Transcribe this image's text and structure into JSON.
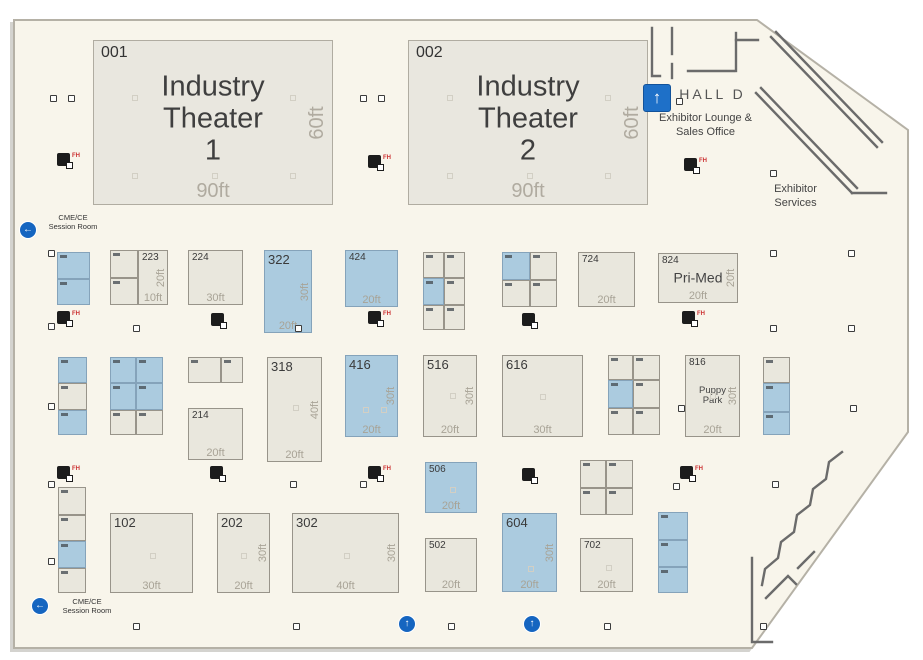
{
  "map": {
    "hall_label": "HALL D",
    "exhibitor_lounge": "Exhibitor Lounge &\nSales Office",
    "exhibitor_services": "Exhibitor\nServices",
    "session_room_top": "CME/CE\nSession Room",
    "session_room_bottom": "CME/CE\nSession Room",
    "colors": {
      "floor": "#f8f5eb",
      "booth_standard": "#e9e7dd",
      "booth_highlight": "#abcbdf",
      "arrow_blue": "#1565c0",
      "fire_label_red": "#cc3333",
      "dimension_gray": "#a8a396"
    }
  },
  "theaters": [
    {
      "booth": "001",
      "name": "Industry\nTheater\n1",
      "width_label": "90ft",
      "depth_label": "60ft"
    },
    {
      "booth": "002",
      "name": "Industry\nTheater\n2",
      "width_label": "90ft",
      "depth_label": "60ft"
    }
  ],
  "booths": [
    {
      "x": 57,
      "y": 252,
      "w": 33,
      "h": 27,
      "c": "b",
      "cell": true
    },
    {
      "x": 57,
      "y": 279,
      "w": 33,
      "h": 26,
      "c": "b",
      "cell": true
    },
    {
      "x": 110,
      "y": 250,
      "w": 28,
      "h": 28,
      "c": "s",
      "cell": true
    },
    {
      "x": 110,
      "y": 278,
      "w": 28,
      "h": 27,
      "c": "s",
      "cell": true
    },
    {
      "x": 138,
      "y": 250,
      "w": 30,
      "h": 55,
      "c": "s",
      "label": "223",
      "hd": "20ft",
      "wd": "10ft"
    },
    {
      "x": 188,
      "y": 250,
      "w": 55,
      "h": 55,
      "c": "s",
      "label": "224",
      "wd": "30ft"
    },
    {
      "x": 264,
      "y": 250,
      "w": 48,
      "h": 83,
      "c": "b",
      "label": "322",
      "lg": true,
      "hd": "30ft",
      "wd": "20ft"
    },
    {
      "x": 345,
      "y": 250,
      "w": 53,
      "h": 57,
      "c": "b",
      "label": "424",
      "wd": "20ft"
    },
    {
      "x": 423,
      "y": 252,
      "w": 21,
      "h": 26,
      "c": "s",
      "cell": true
    },
    {
      "x": 444,
      "y": 252,
      "w": 21,
      "h": 26,
      "c": "s",
      "cell": true
    },
    {
      "x": 423,
      "y": 278,
      "w": 21,
      "h": 27,
      "c": "b",
      "cell": true
    },
    {
      "x": 444,
      "y": 278,
      "w": 21,
      "h": 27,
      "c": "s",
      "cell": true
    },
    {
      "x": 423,
      "y": 305,
      "w": 21,
      "h": 25,
      "c": "s",
      "cell": true
    },
    {
      "x": 444,
      "y": 305,
      "w": 21,
      "h": 25,
      "c": "s",
      "cell": true
    },
    {
      "x": 502,
      "y": 252,
      "w": 28,
      "h": 28,
      "c": "b",
      "cell": true
    },
    {
      "x": 530,
      "y": 252,
      "w": 27,
      "h": 28,
      "c": "s",
      "cell": true
    },
    {
      "x": 502,
      "y": 280,
      "w": 28,
      "h": 27,
      "c": "s",
      "cell": true
    },
    {
      "x": 530,
      "y": 280,
      "w": 27,
      "h": 27,
      "c": "s",
      "cell": true
    },
    {
      "x": 578,
      "y": 252,
      "w": 57,
      "h": 55,
      "c": "s",
      "label": "724",
      "wd": "20ft"
    },
    {
      "x": 658,
      "y": 253,
      "w": 80,
      "h": 50,
      "c": "s",
      "label": "824",
      "name": "Pri-Med",
      "hd": "20ft",
      "wd": "20ft"
    },
    {
      "x": 58,
      "y": 357,
      "w": 29,
      "h": 26,
      "c": "b",
      "cell": true
    },
    {
      "x": 58,
      "y": 383,
      "w": 29,
      "h": 27,
      "c": "s",
      "cell": true
    },
    {
      "x": 58,
      "y": 410,
      "w": 29,
      "h": 25,
      "c": "b",
      "cell": true
    },
    {
      "x": 110,
      "y": 357,
      "w": 26,
      "h": 26,
      "c": "b",
      "cell": true
    },
    {
      "x": 136,
      "y": 357,
      "w": 27,
      "h": 26,
      "c": "b",
      "cell": true
    },
    {
      "x": 110,
      "y": 383,
      "w": 26,
      "h": 27,
      "c": "b",
      "cell": true
    },
    {
      "x": 136,
      "y": 383,
      "w": 27,
      "h": 27,
      "c": "b",
      "cell": true
    },
    {
      "x": 110,
      "y": 410,
      "w": 26,
      "h": 25,
      "c": "s",
      "cell": true
    },
    {
      "x": 136,
      "y": 410,
      "w": 27,
      "h": 25,
      "c": "s",
      "cell": true
    },
    {
      "x": 188,
      "y": 357,
      "w": 33,
      "h": 26,
      "c": "s",
      "cell": true
    },
    {
      "x": 221,
      "y": 357,
      "w": 22,
      "h": 26,
      "c": "s",
      "cell": true
    },
    {
      "x": 188,
      "y": 408,
      "w": 55,
      "h": 52,
      "c": "s",
      "label": "214",
      "wd": "20ft"
    },
    {
      "x": 267,
      "y": 357,
      "w": 55,
      "h": 105,
      "c": "s",
      "label": "318",
      "lg": true,
      "hd": "40ft",
      "wd": "20ft"
    },
    {
      "x": 345,
      "y": 355,
      "w": 53,
      "h": 82,
      "c": "b",
      "label": "416",
      "lg": true,
      "hd": "30ft",
      "wd": "20ft"
    },
    {
      "x": 423,
      "y": 355,
      "w": 54,
      "h": 82,
      "c": "s",
      "label": "516",
      "lg": true,
      "hd": "30ft",
      "wd": "20ft"
    },
    {
      "x": 502,
      "y": 355,
      "w": 81,
      "h": 82,
      "c": "s",
      "label": "616",
      "lg": true,
      "wd": "30ft"
    },
    {
      "x": 608,
      "y": 355,
      "w": 25,
      "h": 25,
      "c": "s",
      "cell": true
    },
    {
      "x": 633,
      "y": 355,
      "w": 27,
      "h": 25,
      "c": "s",
      "cell": true
    },
    {
      "x": 608,
      "y": 380,
      "w": 25,
      "h": 28,
      "c": "b",
      "cell": true
    },
    {
      "x": 633,
      "y": 380,
      "w": 27,
      "h": 28,
      "c": "s",
      "cell": true
    },
    {
      "x": 608,
      "y": 408,
      "w": 25,
      "h": 27,
      "c": "s",
      "cell": true
    },
    {
      "x": 633,
      "y": 408,
      "w": 27,
      "h": 27,
      "c": "s",
      "cell": true
    },
    {
      "x": 685,
      "y": 355,
      "w": 55,
      "h": 82,
      "c": "s",
      "label": "816",
      "name": "Puppy\nPark",
      "sm": true,
      "hd": "30ft",
      "wd": "20ft"
    },
    {
      "x": 763,
      "y": 357,
      "w": 27,
      "h": 26,
      "c": "s",
      "cell": true
    },
    {
      "x": 763,
      "y": 383,
      "w": 27,
      "h": 29,
      "c": "b",
      "cell": true
    },
    {
      "x": 763,
      "y": 412,
      "w": 27,
      "h": 23,
      "c": "b",
      "cell": true
    },
    {
      "x": 58,
      "y": 487,
      "w": 28,
      "h": 28,
      "c": "s",
      "cell": true
    },
    {
      "x": 58,
      "y": 515,
      "w": 28,
      "h": 26,
      "c": "s",
      "cell": true
    },
    {
      "x": 58,
      "y": 541,
      "w": 28,
      "h": 27,
      "c": "b",
      "cell": true
    },
    {
      "x": 58,
      "y": 568,
      "w": 28,
      "h": 25,
      "c": "s",
      "cell": true
    },
    {
      "x": 110,
      "y": 513,
      "w": 83,
      "h": 80,
      "c": "s",
      "label": "102",
      "lg": true,
      "wd": "30ft"
    },
    {
      "x": 217,
      "y": 513,
      "w": 53,
      "h": 80,
      "c": "s",
      "label": "202",
      "lg": true,
      "hd": "30ft",
      "wd": "20ft"
    },
    {
      "x": 292,
      "y": 513,
      "w": 107,
      "h": 80,
      "c": "s",
      "label": "302",
      "lg": true,
      "hd": "30ft",
      "wd": "40ft"
    },
    {
      "x": 425,
      "y": 462,
      "w": 52,
      "h": 51,
      "c": "b",
      "label": "506",
      "wd": "20ft"
    },
    {
      "x": 425,
      "y": 538,
      "w": 52,
      "h": 54,
      "c": "s",
      "label": "502",
      "wd": "20ft"
    },
    {
      "x": 502,
      "y": 513,
      "w": 55,
      "h": 79,
      "c": "b",
      "label": "604",
      "lg": true,
      "hd": "30ft",
      "wd": "20ft"
    },
    {
      "x": 580,
      "y": 460,
      "w": 26,
      "h": 28,
      "c": "s",
      "cell": true
    },
    {
      "x": 606,
      "y": 460,
      "w": 27,
      "h": 28,
      "c": "s",
      "cell": true
    },
    {
      "x": 580,
      "y": 488,
      "w": 26,
      "h": 27,
      "c": "s",
      "cell": true
    },
    {
      "x": 606,
      "y": 488,
      "w": 27,
      "h": 27,
      "c": "s",
      "cell": true
    },
    {
      "x": 580,
      "y": 538,
      "w": 53,
      "h": 54,
      "c": "s",
      "label": "702",
      "wd": "20ft"
    },
    {
      "x": 658,
      "y": 512,
      "w": 30,
      "h": 28,
      "c": "b",
      "cell": true
    },
    {
      "x": 658,
      "y": 540,
      "w": 30,
      "h": 27,
      "c": "b",
      "cell": true
    },
    {
      "x": 658,
      "y": 567,
      "w": 30,
      "h": 26,
      "c": "b",
      "cell": true
    }
  ],
  "fire_markers": [
    {
      "x": 57,
      "y": 153,
      "t": "FH"
    },
    {
      "x": 368,
      "y": 155,
      "t": "FH"
    },
    {
      "x": 684,
      "y": 158,
      "t": "FH"
    },
    {
      "x": 57,
      "y": 311,
      "t": "FH"
    },
    {
      "x": 211,
      "y": 313,
      "t": ""
    },
    {
      "x": 368,
      "y": 311,
      "t": "FH"
    },
    {
      "x": 522,
      "y": 313,
      "t": ""
    },
    {
      "x": 682,
      "y": 311,
      "t": "FH"
    },
    {
      "x": 57,
      "y": 466,
      "t": "FH"
    },
    {
      "x": 210,
      "y": 466,
      "t": ""
    },
    {
      "x": 368,
      "y": 466,
      "t": "FH"
    },
    {
      "x": 522,
      "y": 468,
      "t": ""
    },
    {
      "x": 680,
      "y": 466,
      "t": "FH"
    }
  ],
  "columns": [
    [
      50,
      95
    ],
    [
      68,
      95
    ],
    [
      360,
      95
    ],
    [
      378,
      95
    ],
    [
      676,
      98
    ],
    [
      770,
      170
    ],
    [
      48,
      250
    ],
    [
      770,
      250
    ],
    [
      848,
      250
    ],
    [
      48,
      323
    ],
    [
      133,
      325
    ],
    [
      295,
      325
    ],
    [
      770,
      325
    ],
    [
      848,
      325
    ],
    [
      48,
      403
    ],
    [
      678,
      405
    ],
    [
      850,
      405
    ],
    [
      48,
      481
    ],
    [
      290,
      481
    ],
    [
      360,
      481
    ],
    [
      673,
      483
    ],
    [
      772,
      481
    ],
    [
      48,
      558
    ],
    [
      133,
      623
    ],
    [
      293,
      623
    ],
    [
      448,
      623
    ],
    [
      604,
      623
    ],
    [
      760,
      623
    ]
  ],
  "dots": [
    [
      132,
      95
    ],
    [
      290,
      95
    ],
    [
      132,
      173
    ],
    [
      212,
      173
    ],
    [
      290,
      173
    ],
    [
      447,
      95
    ],
    [
      605,
      95
    ],
    [
      447,
      173
    ],
    [
      527,
      173
    ],
    [
      605,
      173
    ],
    [
      293,
      405
    ],
    [
      363,
      407
    ],
    [
      381,
      407
    ],
    [
      450,
      393
    ],
    [
      540,
      394
    ],
    [
      710,
      393
    ],
    [
      150,
      553
    ],
    [
      241,
      553
    ],
    [
      344,
      553
    ],
    [
      528,
      566
    ],
    [
      450,
      487
    ],
    [
      606,
      565
    ]
  ],
  "arrows": [
    {
      "shape": "square",
      "dir": "up",
      "x": 643,
      "y": 84
    },
    {
      "shape": "circle",
      "dir": "left",
      "x": 20,
      "y": 222
    },
    {
      "shape": "circle",
      "dir": "left",
      "x": 32,
      "y": 598
    },
    {
      "shape": "circle",
      "dir": "up",
      "x": 399,
      "y": 616
    },
    {
      "shape": "circle",
      "dir": "up",
      "x": 524,
      "y": 616
    }
  ]
}
